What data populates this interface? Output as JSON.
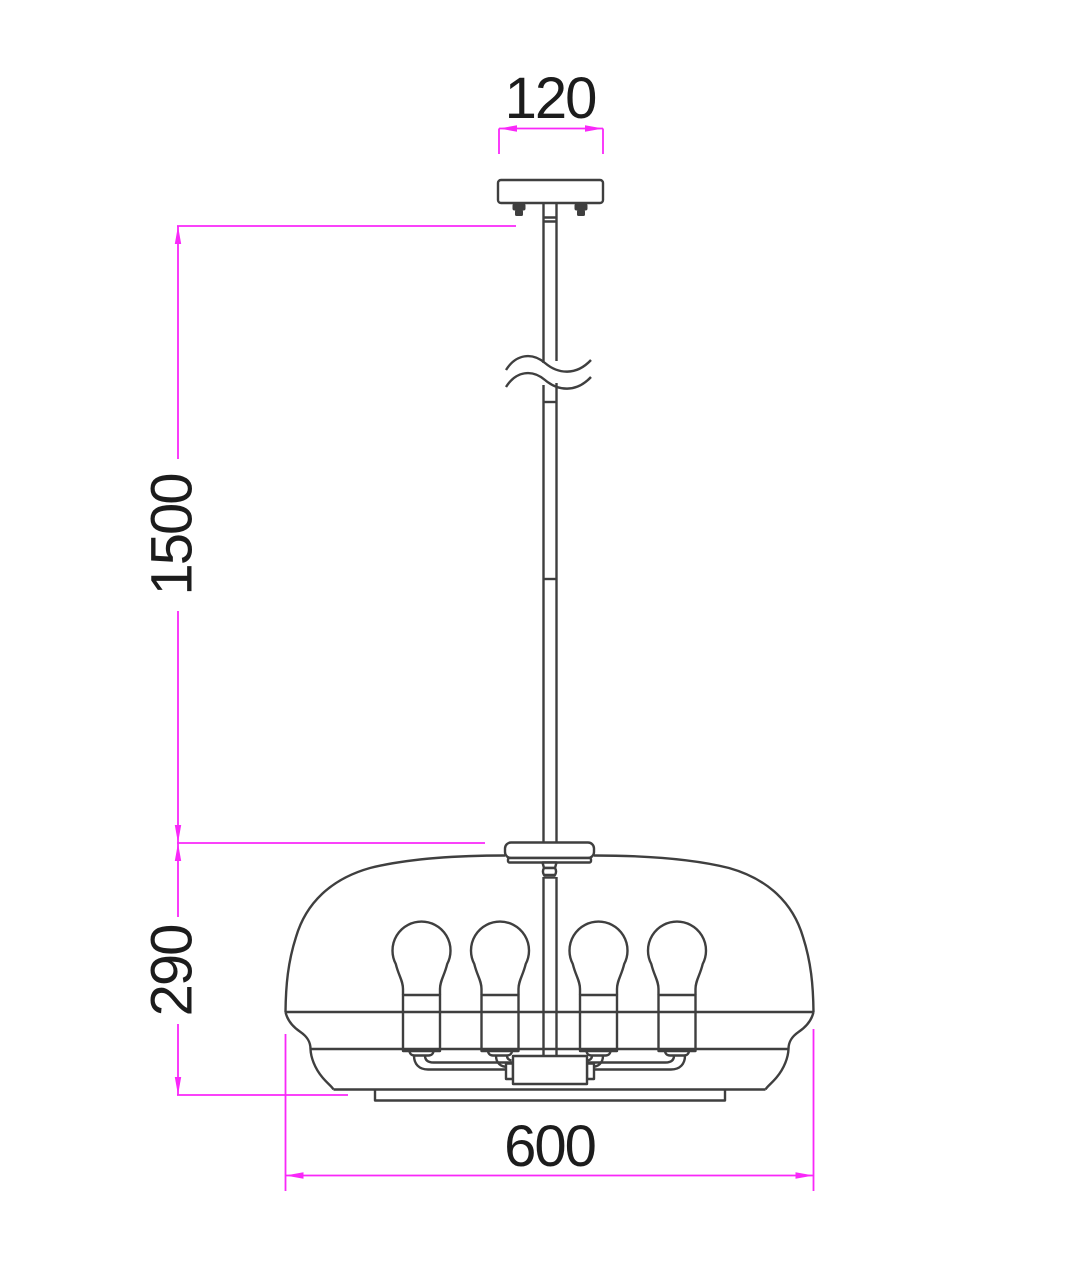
{
  "dimensions": {
    "canopy_width": {
      "label": "120"
    },
    "suspension_height": {
      "label": "1500"
    },
    "shade_height": {
      "label": "290"
    },
    "shade_diameter": {
      "label": "600"
    }
  },
  "fixture": {
    "bulbs_visible": 4
  },
  "colors": {
    "dimension_lines": "#f928f9",
    "outline": "#3f3f3f",
    "label_text": "#1c1c1c",
    "background": "#ffffff"
  }
}
